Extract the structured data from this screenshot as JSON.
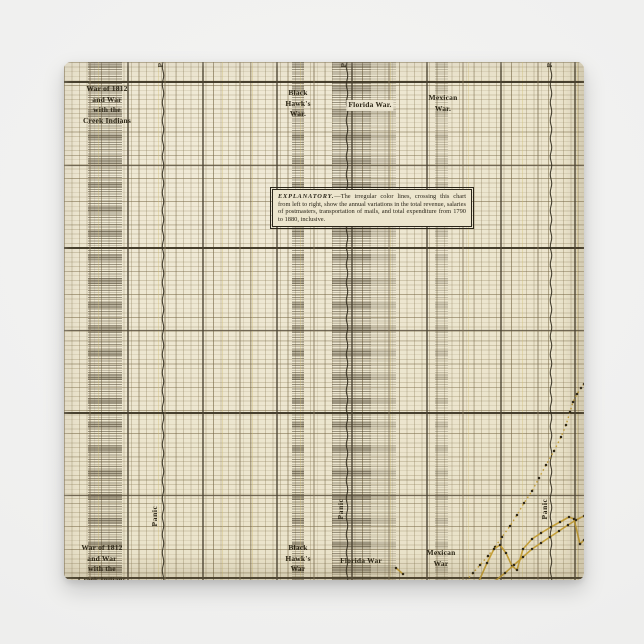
{
  "scene": {
    "background_color": "#efefee",
    "paper_color": "#ebe4cc",
    "accent_gold": "#c19a2e",
    "ink_dark": "#3f3827"
  },
  "labels": {
    "war1812_top": {
      "lines": [
        "War of 1812",
        "and War",
        "with the",
        "Creek Indians"
      ]
    },
    "war1812_bottom": {
      "lines": [
        "War of 1812",
        "and War",
        "with the",
        "Creek Indians"
      ]
    },
    "blackhawk_top": {
      "lines": [
        "Black",
        "Hawk's",
        "War."
      ]
    },
    "blackhawk_bottom": {
      "lines": [
        "Black",
        "Hawk's",
        "War"
      ]
    },
    "florida_top": {
      "text": "Florida War."
    },
    "florida_bottom": {
      "text": "Florida War"
    },
    "mexican_top": {
      "lines": [
        "Mexican",
        "War."
      ]
    },
    "mexican_bottom": {
      "lines": [
        "Mexican",
        "War"
      ]
    },
    "panic": {
      "text": "Panic"
    }
  },
  "explanatory": {
    "heading": "EXPLANATORY.",
    "body": "—The irregular color lines, crossing this chart from left to right, show the annual variations in the total revenue, salaries of postmasters, transportation of mails, and total expenditure from 1790 to 1880, inclusive."
  },
  "grid": {
    "strong_h_y": [
      20,
      186,
      351,
      516
    ],
    "medium_h_y": [
      103.5,
      268.5,
      433.5
    ],
    "heavy_v_x": [
      64,
      139,
      213,
      288,
      363,
      437,
      511
    ],
    "medium_v_x": [
      26,
      101,
      176,
      250,
      325,
      399,
      474
    ],
    "aging_streak_x": [
      34,
      94,
      158,
      188,
      236,
      326,
      404,
      458,
      513
    ]
  },
  "chart_data": {
    "type": "line",
    "legend_position": "none",
    "grid": "on",
    "note": "antique postal-finance chart, axes cropped out of view; coordinates are paper pixels",
    "annotations": [
      {
        "label": "War of 1812 and War with the Creek Indians",
        "kind": "war-band"
      },
      {
        "label": "Black Hawk's War",
        "kind": "war-band"
      },
      {
        "label": "Florida War",
        "kind": "war-band"
      },
      {
        "label": "Mexican War",
        "kind": "war-band"
      },
      {
        "label": "Panic",
        "kind": "panic-line"
      },
      {
        "label": "Panic",
        "kind": "panic-line"
      },
      {
        "label": "Panic",
        "kind": "panic-line"
      }
    ],
    "war_bands": [
      {
        "name": "war-of-1812",
        "x": 24,
        "width": 34,
        "density": "dense"
      },
      {
        "name": "black-hawks-war",
        "x": 228,
        "width": 12,
        "density": "dense"
      },
      {
        "name": "florida-war",
        "x": 268,
        "width": 39,
        "density": "dense"
      },
      {
        "name": "florida-war-2",
        "x": 307,
        "width": 25,
        "density": "light"
      },
      {
        "name": "mexican-war",
        "x": 371,
        "width": 13,
        "density": "light"
      }
    ],
    "panic_lines_x": [
      99,
      283,
      487
    ],
    "series": [
      {
        "name": "gold-dotted",
        "style": "dotted",
        "points": [
          [
            402,
            519
          ],
          [
            409,
            511
          ],
          [
            416,
            503
          ],
          [
            424,
            494
          ],
          [
            431,
            485
          ],
          [
            438,
            475
          ],
          [
            446,
            464
          ],
          [
            453,
            453
          ],
          [
            460,
            441
          ],
          [
            468,
            429
          ],
          [
            475,
            416
          ],
          [
            482,
            403
          ],
          [
            490,
            389
          ],
          [
            497,
            375
          ],
          [
            502,
            363
          ],
          [
            506,
            350
          ],
          [
            509,
            340
          ],
          [
            513,
            332
          ],
          [
            517,
            326
          ],
          [
            520,
            322
          ]
        ]
      },
      {
        "name": "gold-solid-upper",
        "style": "solid",
        "points": [
          [
            415,
            519
          ],
          [
            423,
            501
          ],
          [
            430,
            487
          ],
          [
            436,
            483
          ],
          [
            442,
            491
          ],
          [
            448,
            504
          ],
          [
            453,
            508
          ],
          [
            459,
            487
          ],
          [
            468,
            477
          ],
          [
            477,
            471
          ],
          [
            487,
            465
          ],
          [
            496,
            460
          ],
          [
            505,
            455
          ],
          [
            510,
            457
          ],
          [
            516,
            482
          ],
          [
            520,
            478
          ]
        ]
      },
      {
        "name": "gold-solid-lower",
        "style": "solid",
        "points": [
          [
            431,
            519
          ],
          [
            441,
            511
          ],
          [
            450,
            503
          ],
          [
            459,
            495
          ],
          [
            468,
            487
          ],
          [
            477,
            481
          ],
          [
            486,
            475
          ],
          [
            495,
            469
          ],
          [
            504,
            463
          ],
          [
            512,
            458
          ],
          [
            520,
            454
          ]
        ]
      },
      {
        "name": "gold-start-tick",
        "style": "solid",
        "points": [
          [
            332,
            506
          ],
          [
            339,
            512
          ]
        ]
      }
    ]
  }
}
